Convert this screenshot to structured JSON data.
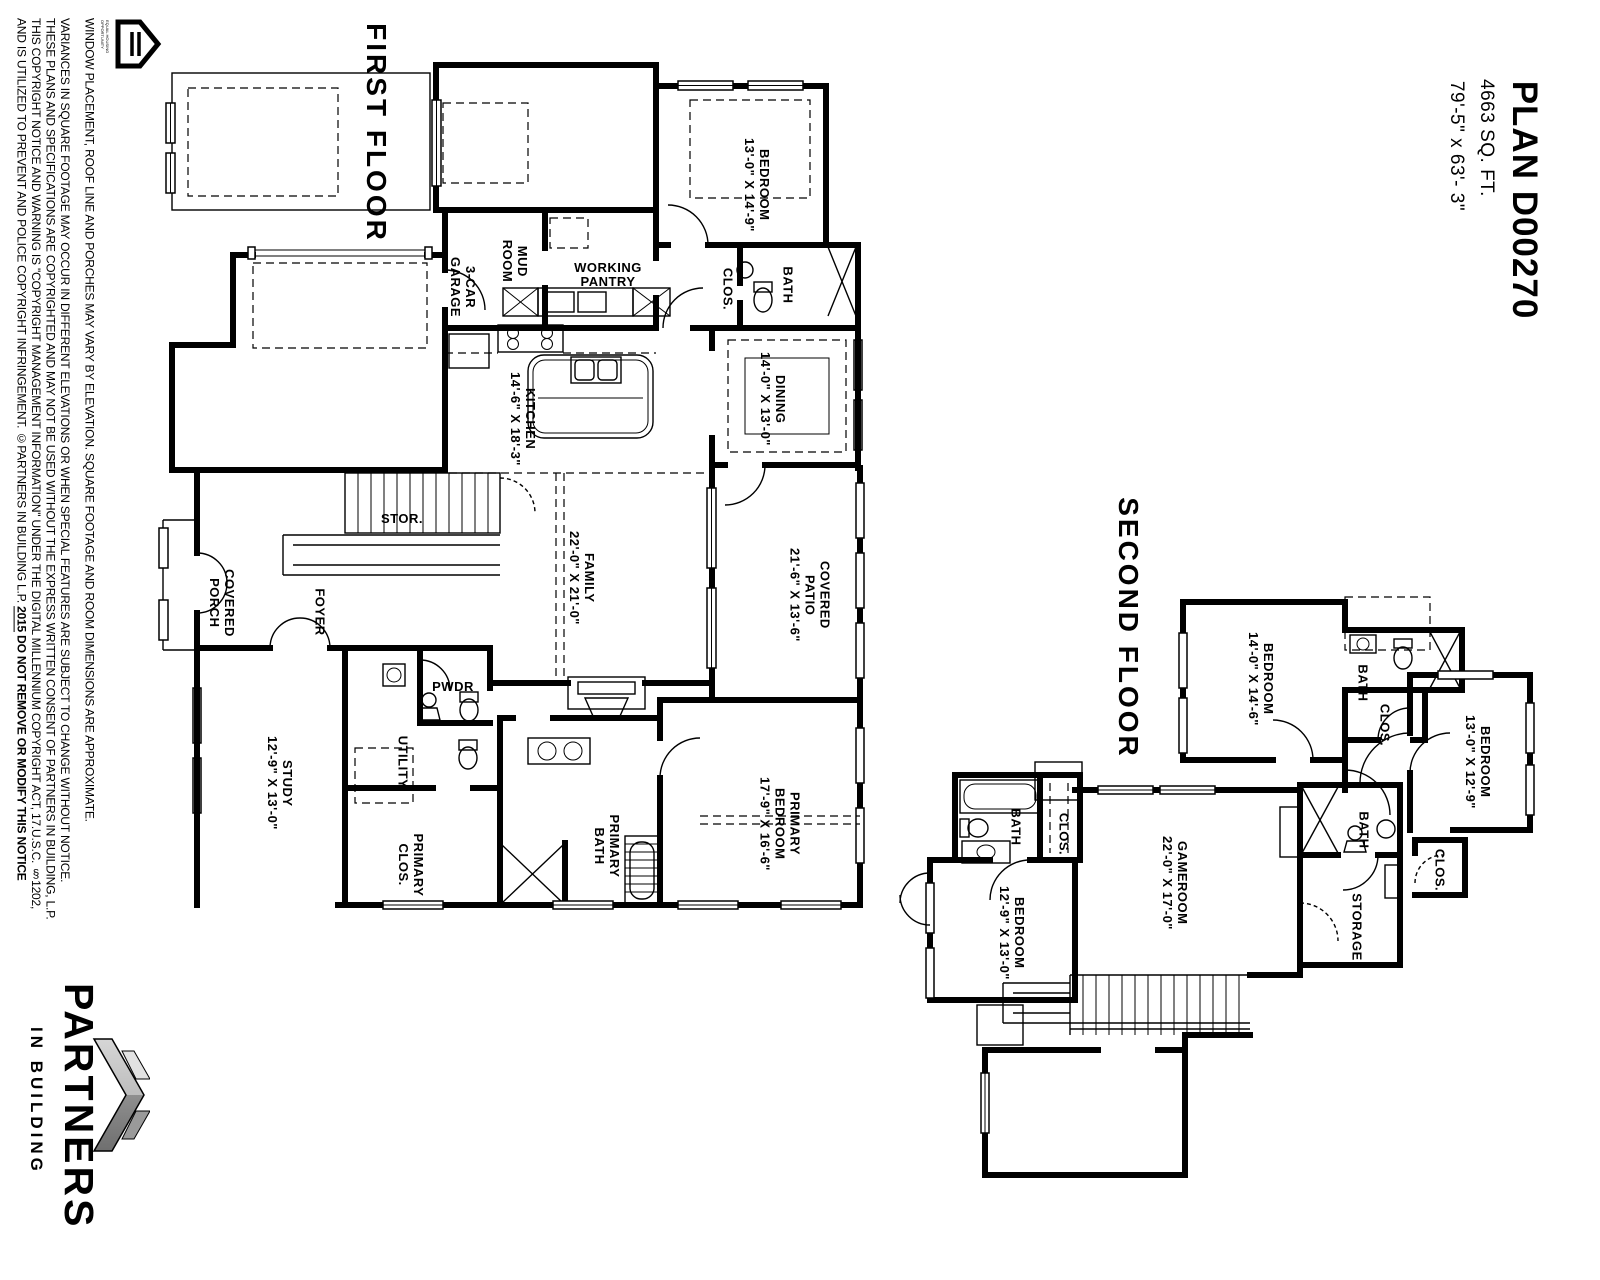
{
  "sheet": {
    "plan_title": "PLAN D00270",
    "area": "4663 SQ. FT.",
    "dimensions": "79'-5\" x 63'- 3\""
  },
  "disclaimer": {
    "lines": [
      "WINDOW PLACEMENT, ROOF LINE AND PORCHES MAY VARY BY ELEVATION.  SQUARE FOOTAGE AND ROOM DIMENSIONS ARE APPROXIMATE.",
      "VARIANCES IN SQUARE FOOTAGE MAY OCCUR IN DIFFERENT ELEVATIONS OR WHEN SPECIAL FEATURES ARE SUBJECT TO CHANGE WITHOUT NOTICE.",
      "THESE PLANS AND SPECIFICATIONS ARE COPYRIGHTED AND MAY NOT BE USED WITHOUT THE EXPRESS WRITTEN CONSENT OF PARTNERS IN BUILDING, L.P.",
      "THIS COPYRIGHT NOTICE AND WARNING IS \"COPYRIGHT MANAGEMENT INFORMATION\" UNDER THE DIGITAL MILLENNIUM COPYRIGHT ACT, 17.U.S.C. §1202,"
    ],
    "line5_normal": "AND IS UTILIZED TO PREVENT AND POLICE COPYRIGHT INFRINGEMENT.  ©PARTNERS IN BUILDING L.P.  ",
    "line5_year": "2015",
    "line5_bold": "   DO NOT REMOVE OR MODIFY THIS NOTICE"
  },
  "logo": {
    "name": "PARTNERS",
    "tagline": "IN BUILDING",
    "chevron_color_light": "#c9c9c9",
    "chevron_color_dark": "#8a8a8a",
    "eho_caption": "EQUAL HOUSING OPPORTUNITY"
  },
  "floors": {
    "first": {
      "title": "FIRST FLOOR",
      "rooms": {
        "garage": [
          "3-CAR",
          "GARAGE"
        ],
        "mud": [
          "MUD",
          "ROOM"
        ],
        "pantry": [
          "WORKING",
          "PANTRY"
        ],
        "bedroom": [
          "BEDROOM",
          "13'-0\" X 14'-9\""
        ],
        "clos": [
          "CLOS."
        ],
        "bath": [
          "BATH"
        ],
        "kitchen": [
          "KITCHEN",
          "14'-6\" X 18'-3\""
        ],
        "dining": [
          "DINING",
          "14'-0\" X 13'-0\""
        ],
        "stor": [
          "STOR."
        ],
        "porch": [
          "COVERED",
          "PORCH"
        ],
        "foyer": [
          "FOYER"
        ],
        "family": [
          "FAMILY",
          "22'-0\" X 21'-0\""
        ],
        "patio": [
          "COVERED",
          "PATIO",
          "21'-6\" X 13'-6\""
        ],
        "pwdr": [
          "PWDR"
        ],
        "utility": [
          "UTILITY"
        ],
        "study": [
          "STUDY",
          "12'-9\" X 13'-0\""
        ],
        "primary_clos": [
          "PRIMARY",
          "CLOS."
        ],
        "primary_bath": [
          "PRIMARY",
          "BATH"
        ],
        "primary_bedroom": [
          "PRIMARY",
          "BEDROOM",
          "17'-9\" X 16'-6\""
        ]
      }
    },
    "second": {
      "title": "SECOND FLOOR",
      "rooms": {
        "bedroom_a": [
          "BEDROOM",
          "14'-0\" X 14'-6\""
        ],
        "bath_a": [
          "BATH"
        ],
        "clos_a": [
          "CLOS."
        ],
        "bedroom_b": [
          "BEDROOM",
          "13'-0\" X 12'-9\""
        ],
        "bath_b": [
          "BATH"
        ],
        "clos_b": [
          "CLOS."
        ],
        "gameroom": [
          "GAMEROOM",
          "22'-0\" X 17'-0\""
        ],
        "bath_c": [
          "BATH"
        ],
        "clos_c": [
          "CLOS."
        ],
        "bedroom_c": [
          "BEDROOM",
          "12'-9\" X 13'-0\""
        ],
        "storage": [
          "STORAGE"
        ]
      }
    }
  }
}
